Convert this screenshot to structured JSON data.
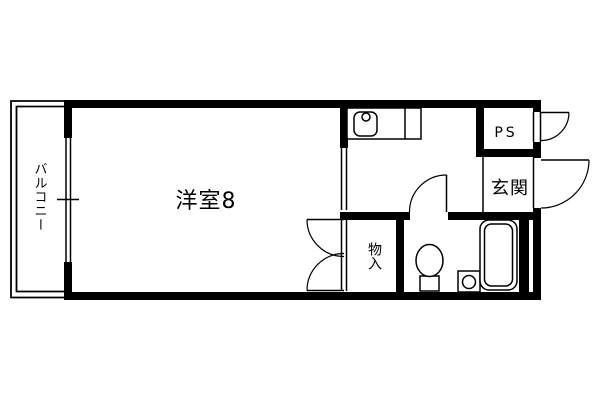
{
  "page": {
    "type": "apartment-floorplan",
    "background_color": "#ffffff",
    "line_color": "#000000"
  },
  "floorplan": {
    "labels": {
      "balcony": "バルコニー",
      "main_room": "洋室8",
      "pipe_space": "PS",
      "entrance": "玄関",
      "closet": "物入"
    },
    "fixtures": [
      "kitchen-counter",
      "kitchen-sink",
      "faucet",
      "toilet",
      "washbasin",
      "bathtub"
    ],
    "doors_and_openings": [
      "balcony-sliding-window",
      "room-hall-opening",
      "closet-double-door",
      "bathroom-door",
      "ps-door",
      "entrance-door"
    ]
  }
}
